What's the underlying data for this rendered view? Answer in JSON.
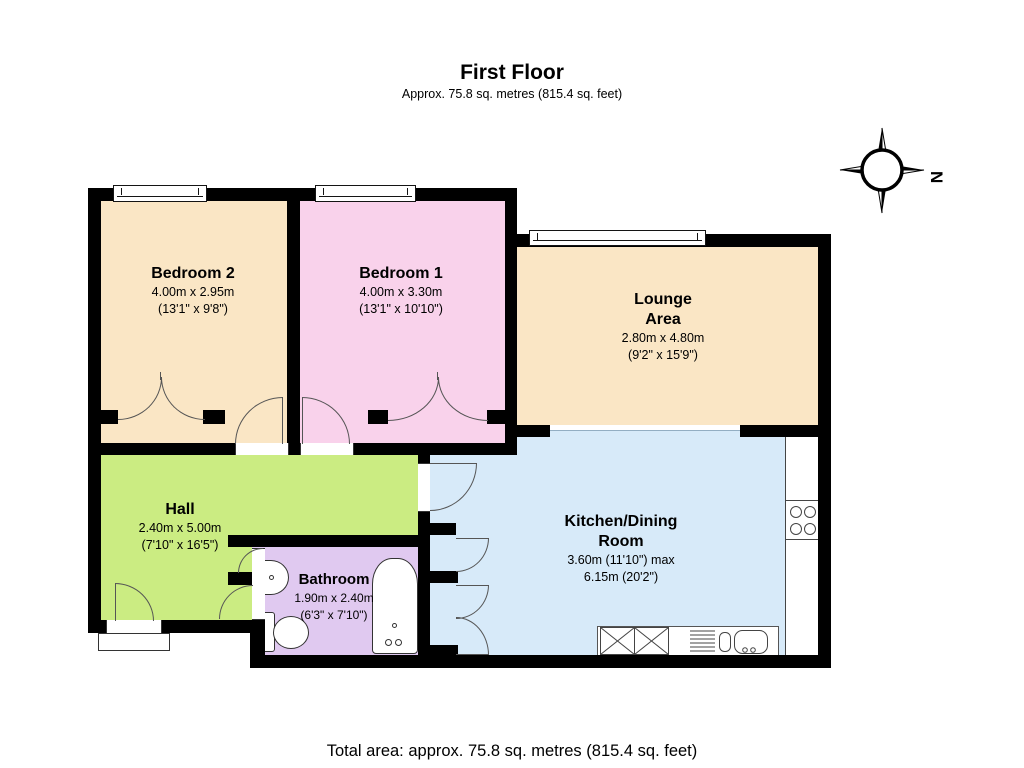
{
  "title": "First Floor",
  "subtitle": "Approx.  75.8 sq. metres (815.4 sq. feet)",
  "footer": "Total area: approx.  75.8 sq. metres (815.4 sq. feet)",
  "compass": {
    "north_label": "N"
  },
  "colors": {
    "wall": "#000000",
    "bedroom2": "#FAE6C5",
    "bedroom1": "#F9D2EB",
    "lounge": "#FAE6C5",
    "hall": "#CBEC82",
    "bathroom": "#E0C9F0",
    "kitchen": "#D7EAF9"
  },
  "rooms": {
    "bedroom2": {
      "name": "Bedroom 2",
      "dim_metric": "4.00m x 2.95m",
      "dim_imperial": "(13'1\" x 9'8\")"
    },
    "bedroom1": {
      "name": "Bedroom 1",
      "dim_metric": "4.00m x 3.30m",
      "dim_imperial": "(13'1\" x 10'10\")"
    },
    "lounge": {
      "name": "Lounge Area",
      "dim_metric": "2.80m x 4.80m",
      "dim_imperial": "(9'2\" x 15'9\")"
    },
    "hall": {
      "name": "Hall",
      "dim_metric": "2.40m x 5.00m",
      "dim_imperial": "(7'10\" x 16'5\")"
    },
    "bathroom": {
      "name": "Bathroom",
      "dim_metric": "1.90m x 2.40m",
      "dim_imperial": "(6'3\" x 7'10\")"
    },
    "kitchen": {
      "name": "Kitchen/Dining Room",
      "dim_metric": "3.60m (11'10\") max",
      "dim_imperial": "6.15m (20'2\")"
    }
  }
}
